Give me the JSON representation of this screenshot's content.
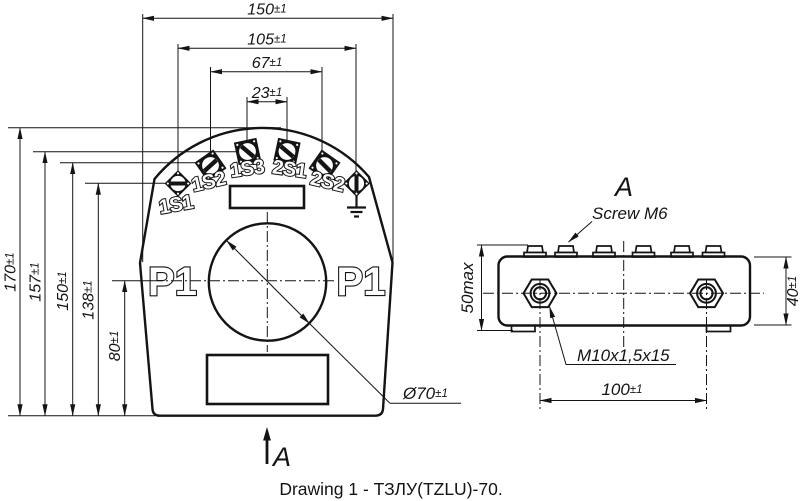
{
  "drawing": {
    "caption": "Drawing 1 - ТЗЛУ(TZLU)-70.",
    "colors": {
      "ink": "#141414",
      "paper": "#ffffff"
    },
    "icons": {
      "ground": "earth-ground-symbol",
      "view_direction": "up-arrow"
    },
    "front_view": {
      "core_label_left": "P1",
      "core_label_right": "P1",
      "view_arrow_label": "A",
      "terminal_labels": [
        "1S1",
        "1S2",
        "1S3",
        "2S1",
        "2S2"
      ],
      "diameter_label": {
        "v": "Ø70",
        "t": "±1"
      },
      "dims_top": [
        {
          "v": "150",
          "t": "±1"
        },
        {
          "v": "105",
          "t": "±1"
        },
        {
          "v": "67",
          "t": "±1"
        },
        {
          "v": "23",
          "t": "±1"
        }
      ],
      "dims_left": [
        {
          "v": "170",
          "t": "±1"
        },
        {
          "v": "157",
          "t": "±1"
        },
        {
          "v": "150",
          "t": "±1"
        },
        {
          "v": "138",
          "t": "±1"
        },
        {
          "v": "80",
          "t": "±1"
        }
      ]
    },
    "side_view": {
      "view_title": "A",
      "screw_callout": "Screw M6",
      "stud_callout": "M10x1,5x15",
      "dim_span": {
        "v": "100",
        "t": "±1"
      },
      "dim_overall_height": "50max",
      "dim_body_height": {
        "v": "40",
        "t": "±1"
      }
    }
  }
}
